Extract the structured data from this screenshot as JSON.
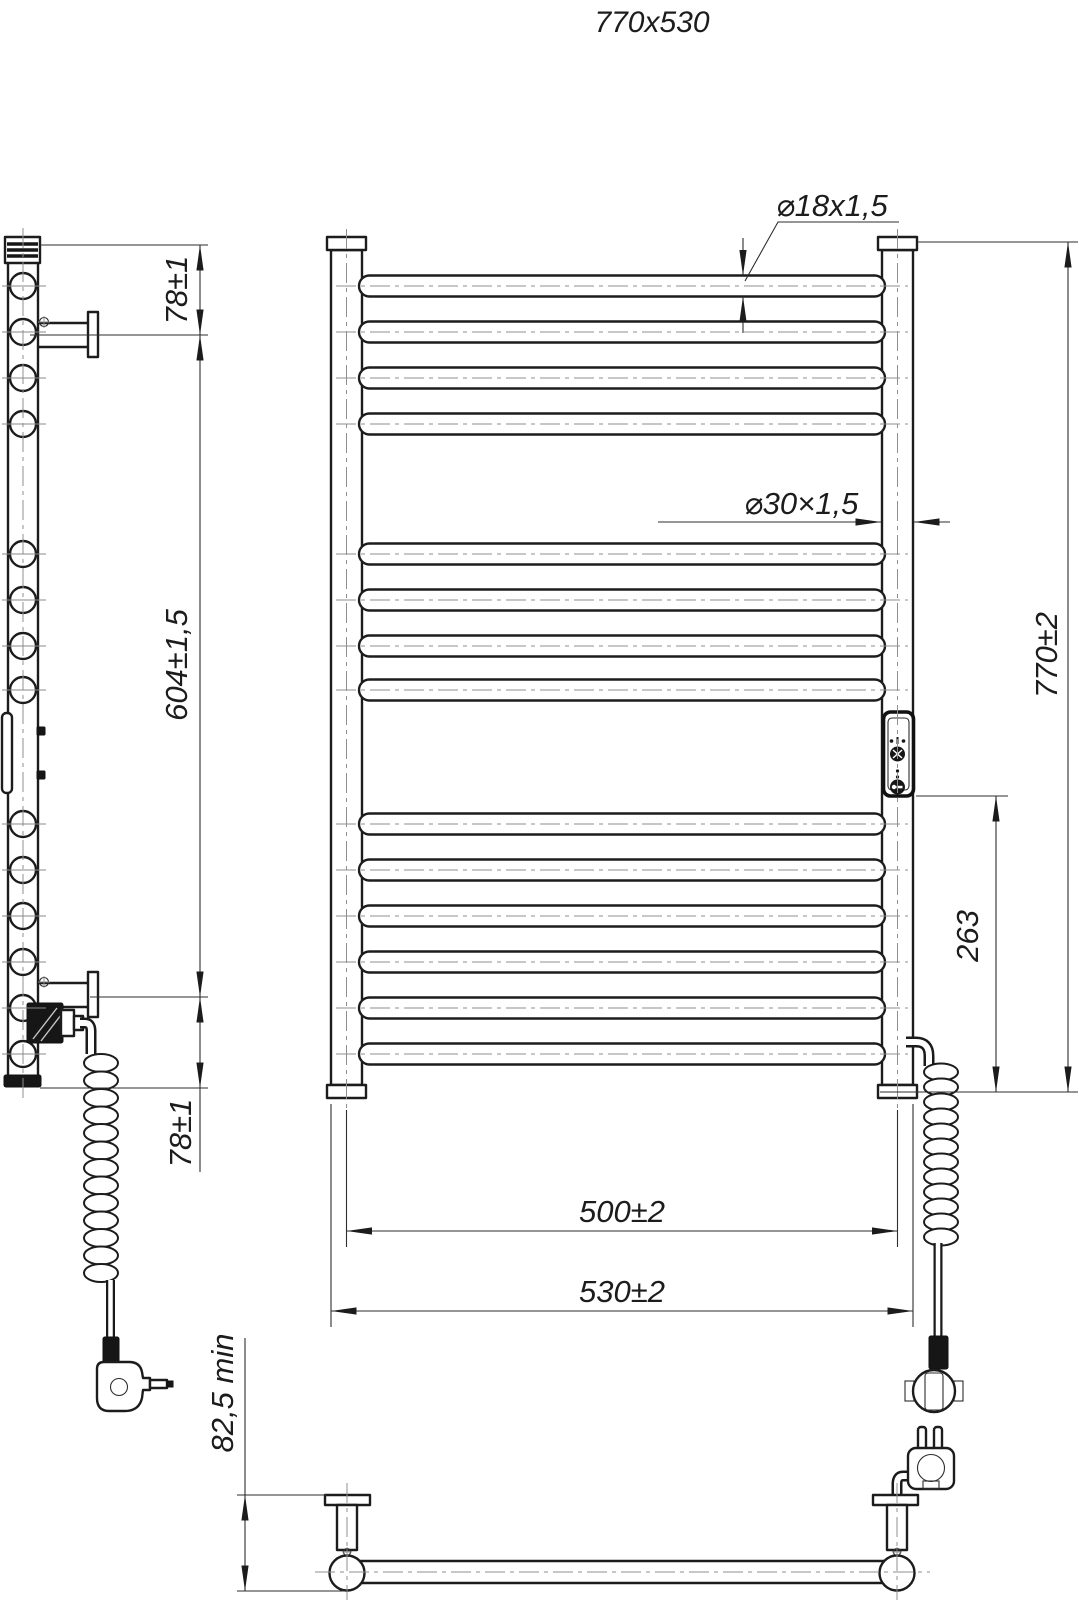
{
  "title": "770x530",
  "dimensions": {
    "tube_diameter": "⌀18x1,5",
    "post_diameter": "⌀30×1,5",
    "overall_height": "770±2",
    "heater_offset": "263",
    "axis_width": "500±2",
    "overall_width": "530±2",
    "bracket_top_offset": "78±1",
    "bracket_span": "604±1,5",
    "bracket_bottom_offset": "78±1",
    "wall_clearance": "82,5 min"
  }
}
